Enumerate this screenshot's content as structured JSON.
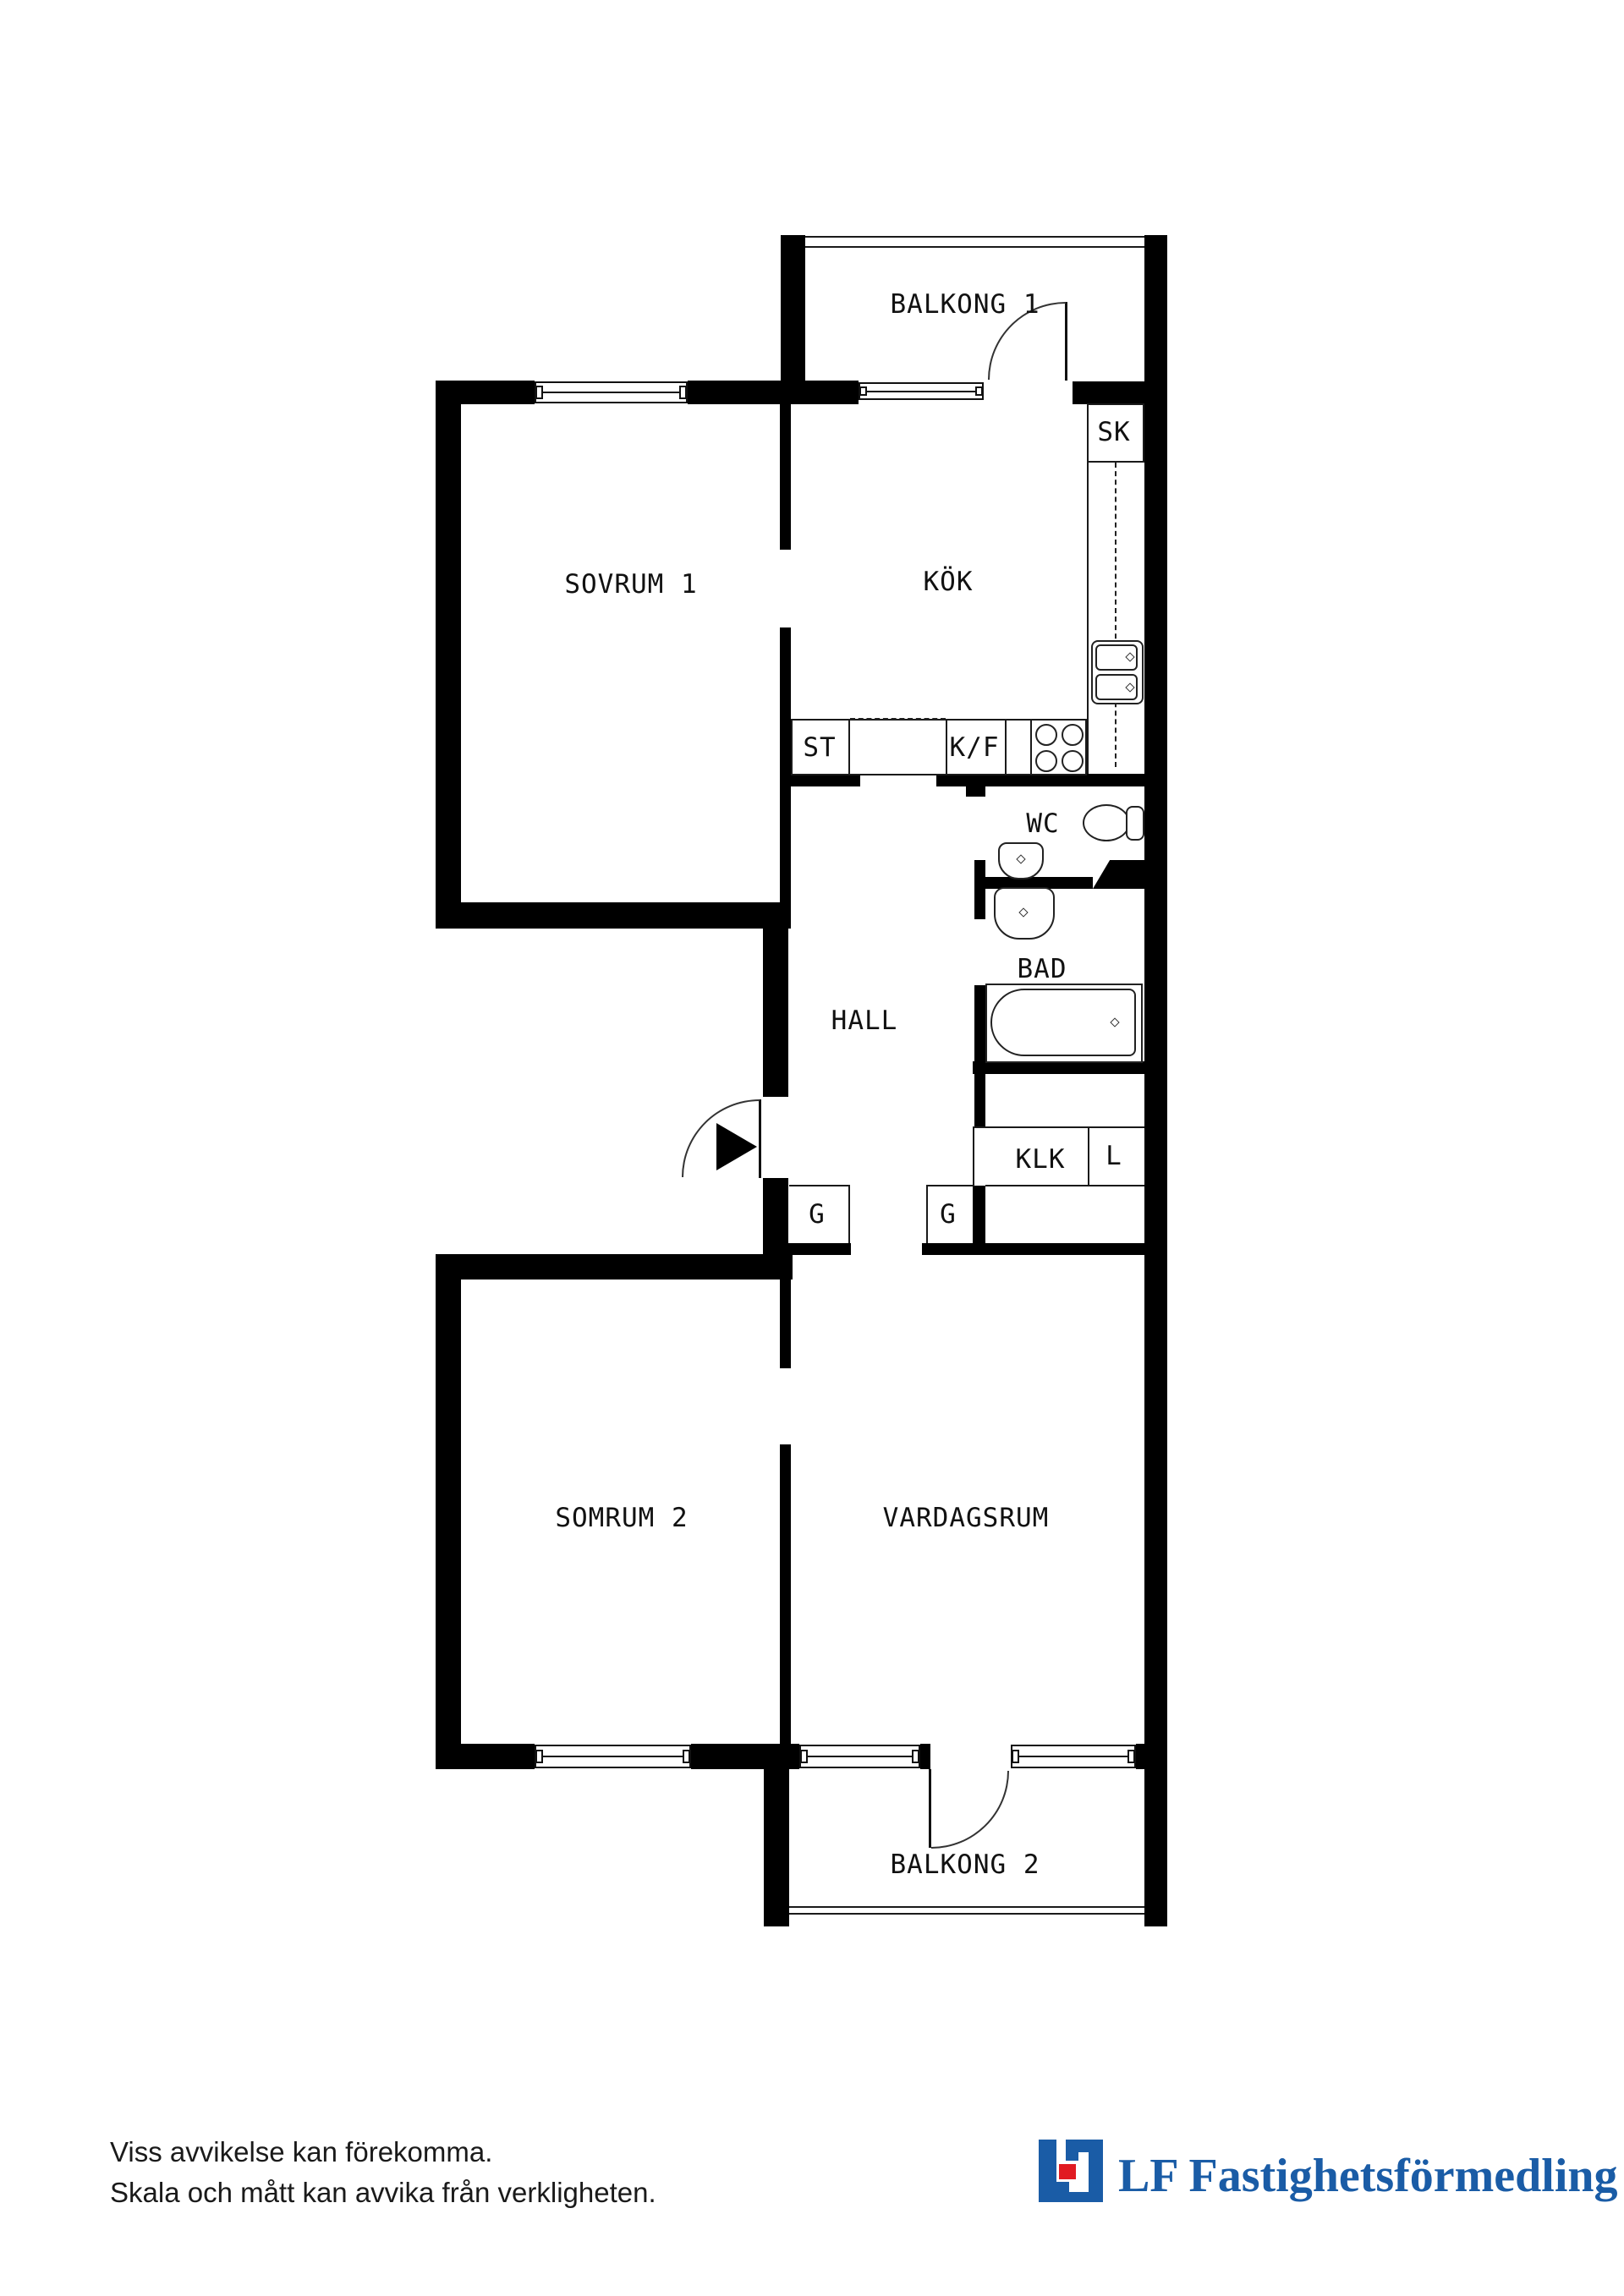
{
  "plan": {
    "rooms": {
      "balkong1": {
        "label": "BALKONG 1"
      },
      "sovrum1": {
        "label": "SOVRUM 1"
      },
      "kok": {
        "label": "KÖK"
      },
      "sk": {
        "label": "SK"
      },
      "st": {
        "label": "ST"
      },
      "kf": {
        "label": "K/F"
      },
      "wc": {
        "label": "WC"
      },
      "bad": {
        "label": "BAD"
      },
      "hall": {
        "label": "HALL"
      },
      "klk": {
        "label": "KLK"
      },
      "linen": {
        "label": "L"
      },
      "g1": {
        "label": "G"
      },
      "g2": {
        "label": "G"
      },
      "somrum2": {
        "label": "SOMRUM 2"
      },
      "vardagsrum": {
        "label": "VARDAGSRUM"
      },
      "balkong2": {
        "label": "BALKONG 2"
      }
    },
    "colors": {
      "wall": "#000000",
      "line": "#1a1a1a",
      "background": "#ffffff"
    }
  },
  "footer": {
    "disclaimer_line1": "Viss avvikelse kan förekomma.",
    "disclaimer_line2": "Skala och mått kan avvika från verkligheten.",
    "logo": {
      "text": "LF Fastighetsförmedling",
      "brand_blue": "#1A5CA6",
      "brand_red": "#E11B22"
    }
  }
}
